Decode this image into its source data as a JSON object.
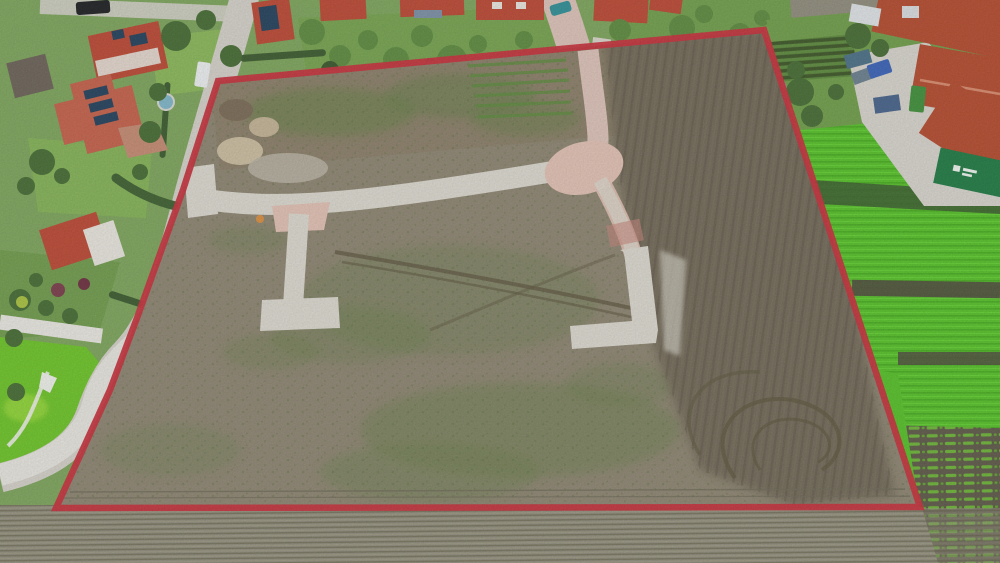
{
  "image": {
    "kind": "aerial-drone-photo",
    "subject": "undeveloped building plot outlined with red boundary, surrounded by houses, a farm, crop fields and a plowed field",
    "width_px": 1000,
    "height_px": 563
  },
  "colors": {
    "boundary_red": "#c62f3b",
    "plot_dirt": "#8d8471",
    "plot_dirt_top": "#8a7d67",
    "dark_soil": "#6e6555",
    "concrete_road": "#dbd8cf",
    "paver_pink": "#e2c1b4",
    "entry_road_pink": "#dcc2b8",
    "street_gray": "#d4d1c9",
    "street_white": "#e9e7e1",
    "crop_green": "#55c028",
    "crop_green_dark": "#47ad1f",
    "crop_gap_soil": "#4e4a3c",
    "row_soil": "#645e4e",
    "row_green": "#6cb437",
    "lawn_green": "#7fae4e",
    "lawn_vivid": "#6cc427",
    "lawn_lime": "#9ada3a",
    "garden_green": "#7ca45b",
    "tree_green": "#456b33",
    "tree_green_light": "#5d8a3f",
    "hedge_green": "#3a5a2e",
    "weed_green": "#647f45",
    "roof_red": "#bb4733",
    "roof_red_light": "#c4604a",
    "farm_roof_red": "#b44a2e",
    "gable_white": "#e8e5de",
    "barn_gray": "#6b6257",
    "courtyard_gray": "#d7d4cd",
    "plow_field": "#8f8c7c",
    "plow_dark_line": "#77745f",
    "plow_light_line": "#9c9883",
    "sand_beige": "#cbbda0",
    "soil_pile_brown": "#7a6a55",
    "rubble_gray": "#b7b0a2",
    "track_brown": "#5e563f",
    "solar_panel": "#22405c",
    "van_white": "#eceff0",
    "car_black": "#1d1f22",
    "car_teal": "#2e8f96",
    "tractor_blue": "#3a62b8",
    "tractor_green": "#3f8f3a",
    "sign_green": "#1f7a43",
    "sign_mark_white": "#eef4ee",
    "white_path": "#eef0ea",
    "pool_blue": "#7fb6c9"
  },
  "scene": {
    "regions": [
      {
        "name": "marked-plot",
        "desc": "bare dirt development plot outlined in red with new concrete access roads"
      },
      {
        "name": "residential-left",
        "desc": "houses with red roofs, solar panels, gardens and curving street"
      },
      {
        "name": "houses-top",
        "desc": "row of red-roofed houses and gardens along top edge"
      },
      {
        "name": "farm-top-right",
        "desc": "farmyard with large red-roofed barns, tractors and paved courtyard"
      },
      {
        "name": "crop-field-right",
        "desc": "bright green crop field with dark harvested strips"
      },
      {
        "name": "row-crops-bottom-right",
        "desc": "rows of young crops on dark soil"
      },
      {
        "name": "plowed-field-bottom",
        "desc": "finely striped plowed field along bottom"
      }
    ],
    "boundary_polygon": [
      [
        218,
        81
      ],
      [
        764,
        30
      ],
      [
        920,
        507
      ],
      [
        56,
        508
      ],
      [
        110,
        390
      ],
      [
        137,
        318
      ],
      [
        183,
        190
      ]
    ]
  }
}
